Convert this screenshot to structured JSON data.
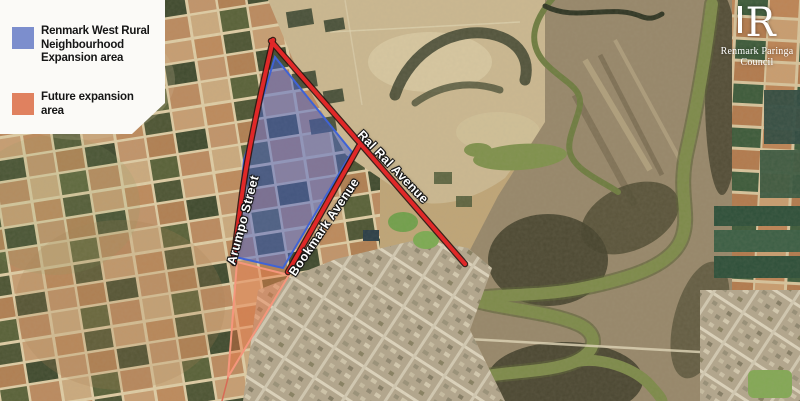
{
  "legend": {
    "items": [
      {
        "id": "expansion-area",
        "label": "Renmark West Rural\nNeighbourhood\nExpansion area",
        "color": "#7c8ecd"
      },
      {
        "id": "future-expansion-area",
        "label": "Future expansion\narea",
        "color": "#e0815f"
      }
    ]
  },
  "street_labels": {
    "arumpo": "Arumpo Street",
    "bookmark": "Bookmark Avenue",
    "ral_ral": "Ral Ral Avenue"
  },
  "logo": {
    "letter": "R",
    "name_line1": "Renmark Paringa",
    "name_line2": "Council"
  },
  "colors": {
    "boundary_red": "#e02828",
    "boundary_casing": "#2b1410",
    "expansion_blue_fill": "rgba(72,98,205,0.5)",
    "expansion_blue_stroke": "#3f63d6",
    "future_orange_fill": "rgba(235,120,70,0.45)",
    "future_orange_stroke": "#f5967c"
  }
}
